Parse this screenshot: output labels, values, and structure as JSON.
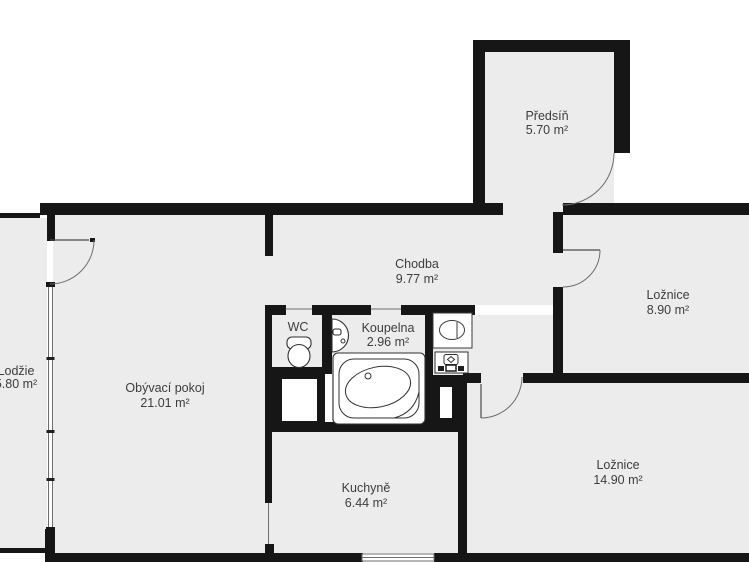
{
  "plan": {
    "rooms": [
      {
        "id": "predsin",
        "name": "Předsíň",
        "area": "5.70 m²"
      },
      {
        "id": "chodba",
        "name": "Chodba",
        "area": "9.77 m²"
      },
      {
        "id": "loznice-1",
        "name": "Ložnice",
        "area": "8.90 m²"
      },
      {
        "id": "obyvaci-pokoj",
        "name": "Obývací pokoj",
        "area": "21.01 m²"
      },
      {
        "id": "koupelna",
        "name": "Koupelna",
        "area": "2.96 m²"
      },
      {
        "id": "wc",
        "name": "WC",
        "area": ""
      },
      {
        "id": "kuchyne",
        "name": "Kuchyně",
        "area": "6.44 m²"
      },
      {
        "id": "loznice-2",
        "name": "Ložnice",
        "area": "14.90 m²"
      },
      {
        "id": "lodzie",
        "name": "Lodžie",
        "area": "5.80 m²"
      }
    ],
    "fixtures": [
      {
        "icon": "toilet-icon"
      },
      {
        "icon": "sink-icon"
      },
      {
        "icon": "corner-bathtub-icon"
      },
      {
        "icon": "washbasin-icon"
      },
      {
        "icon": "washing-machine-icon"
      }
    ],
    "colors": {
      "wall": "#161616",
      "floor": "#ececec",
      "line": "#6e6e6e",
      "text": "#3d3d3d",
      "background": "#ffffff"
    }
  }
}
